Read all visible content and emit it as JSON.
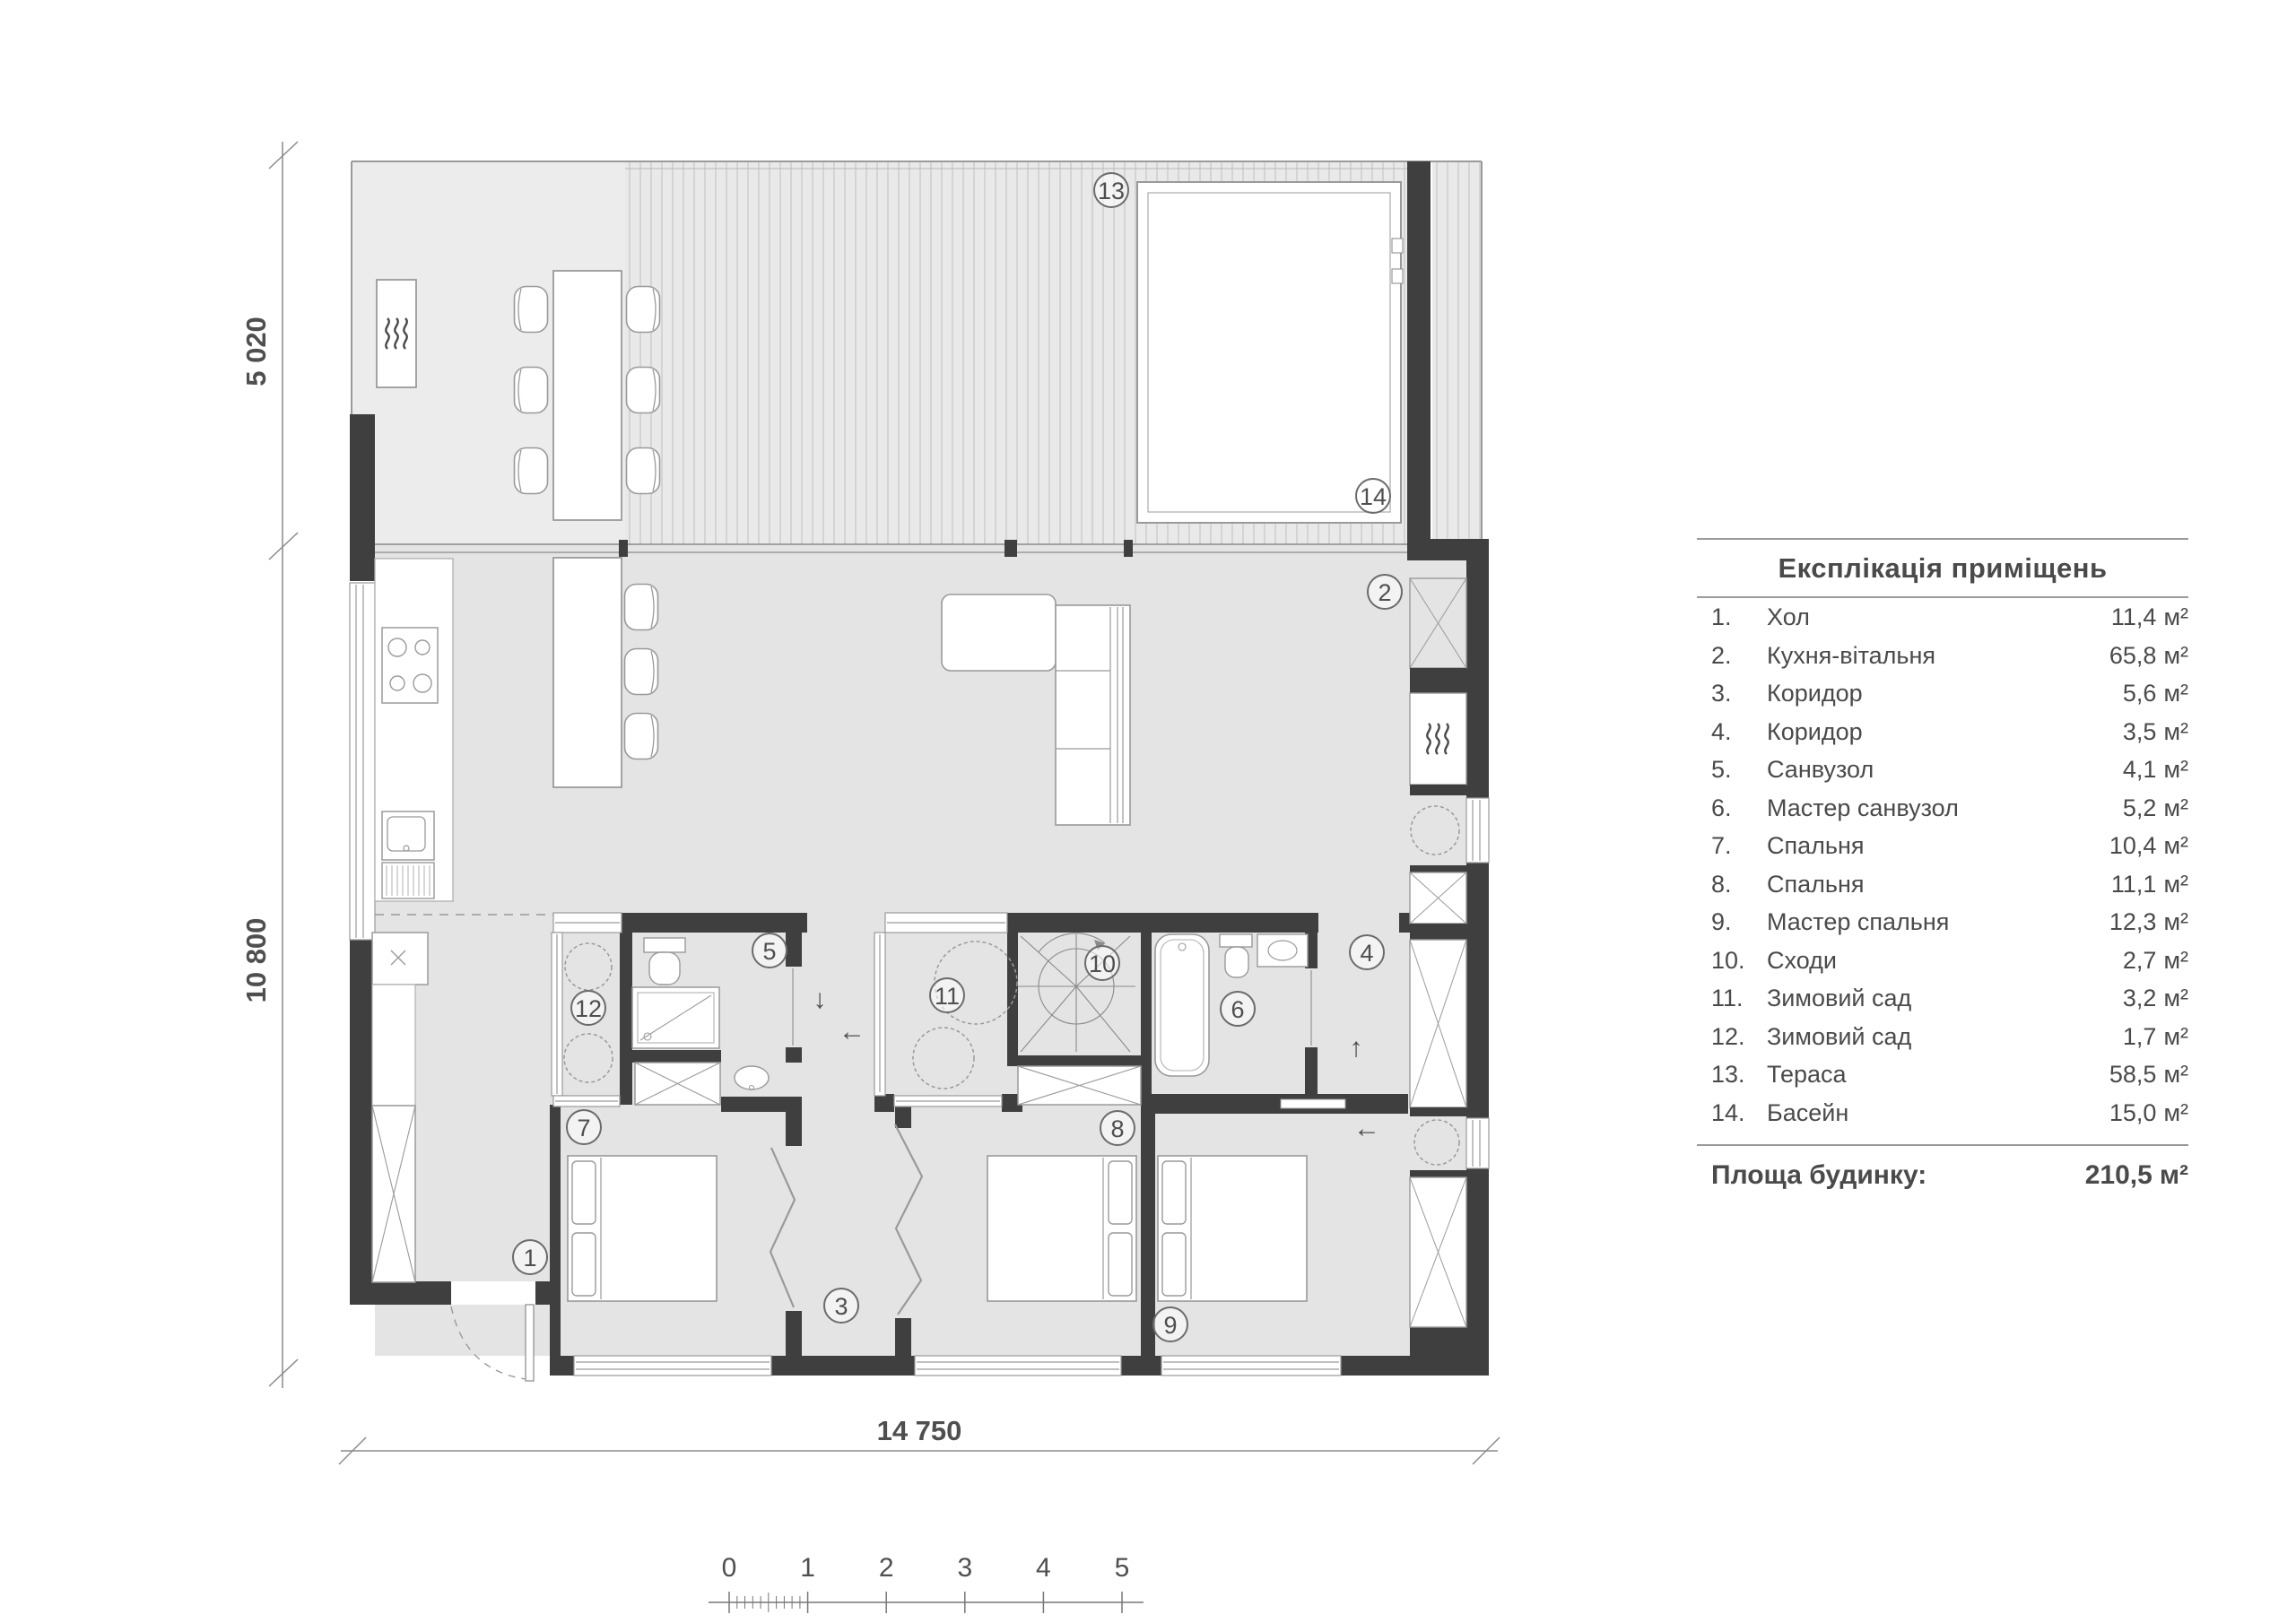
{
  "legend": {
    "title": "Експлікація приміщень",
    "unit": "м²",
    "rows": [
      {
        "num": "1.",
        "name": "Хол",
        "area": "11,4"
      },
      {
        "num": "2.",
        "name": "Кухня-вітальня",
        "area": "65,8"
      },
      {
        "num": "3.",
        "name": "Коридор",
        "area": "5,6"
      },
      {
        "num": "4.",
        "name": "Коридор",
        "area": "3,5"
      },
      {
        "num": "5.",
        "name": "Санвузол",
        "area": "4,1"
      },
      {
        "num": "6.",
        "name": "Мастер санвузол",
        "area": "5,2"
      },
      {
        "num": "7.",
        "name": "Спальня",
        "area": "10,4"
      },
      {
        "num": "8.",
        "name": "Спальня",
        "area": "11,1"
      },
      {
        "num": "9.",
        "name": "Мастер спальня",
        "area": "12,3"
      },
      {
        "num": "10.",
        "name": "Сходи",
        "area": "2,7"
      },
      {
        "num": "11.",
        "name": "Зимовий сад",
        "area": "3,2"
      },
      {
        "num": "12.",
        "name": "Зимовий сад",
        "area": "1,7"
      },
      {
        "num": "13.",
        "name": "Тераса",
        "area": "58,5"
      },
      {
        "num": "14.",
        "name": "Басейн",
        "area": "15,0"
      }
    ],
    "total_label": "Площа будинку:",
    "total_value": "210,5"
  },
  "dimensions": {
    "left_top": "5 020",
    "left_bottom": "10 800",
    "bottom": "14 750"
  },
  "scalebar": {
    "labels": [
      "0",
      "1",
      "2",
      "3",
      "4",
      "5"
    ]
  },
  "plan": {
    "rooms": [
      {
        "num": "1"
      },
      {
        "num": "2"
      },
      {
        "num": "3"
      },
      {
        "num": "4"
      },
      {
        "num": "5"
      },
      {
        "num": "6"
      },
      {
        "num": "7"
      },
      {
        "num": "8"
      },
      {
        "num": "9"
      },
      {
        "num": "10"
      },
      {
        "num": "11"
      },
      {
        "num": "12"
      },
      {
        "num": "13"
      },
      {
        "num": "14"
      }
    ],
    "arrows": {
      "down": "↓",
      "left": "←",
      "up": "↑"
    }
  },
  "colors": {
    "wall": "#3f3f3f",
    "floor": "#e4e4e4",
    "terrace": "#ececec",
    "stripe": "#c6c6c6",
    "line": "#9a9a9a",
    "text": "#4a4a4a"
  }
}
